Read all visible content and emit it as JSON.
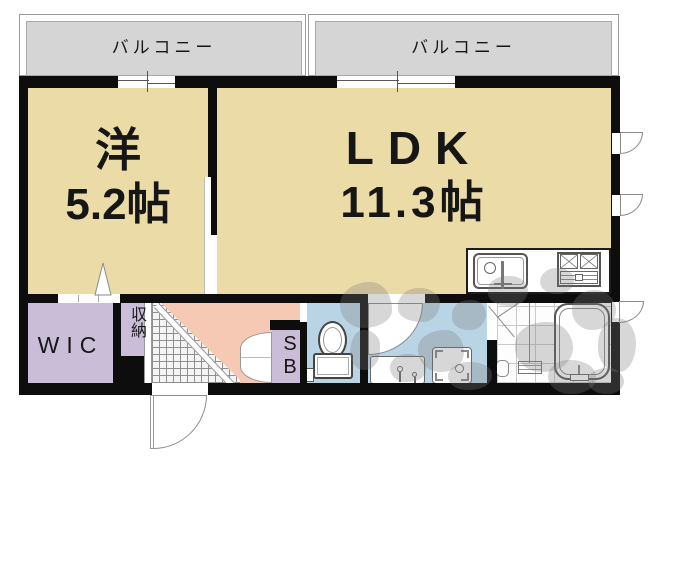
{
  "floorplan": {
    "balconies": {
      "left_label": "バルコニー",
      "right_label": "バルコニー"
    },
    "rooms": {
      "bedroom": {
        "name": "洋",
        "area": "5.2帖"
      },
      "ldk": {
        "name": "LDK",
        "area": "11.3帖"
      },
      "wic": {
        "label": "WIC"
      },
      "storage": {
        "label": "収納"
      },
      "shoe_box": {
        "label": "SB"
      }
    },
    "colors": {
      "room_floor": "#ebdca7",
      "balcony": "#d5d5d5",
      "closet": "#cabdd8",
      "hall": "#f5c9b3",
      "wet_area": "#b9d4e5",
      "wall": "#0d0d0d",
      "watermark": "rgba(122,122,122,0.30)"
    }
  }
}
